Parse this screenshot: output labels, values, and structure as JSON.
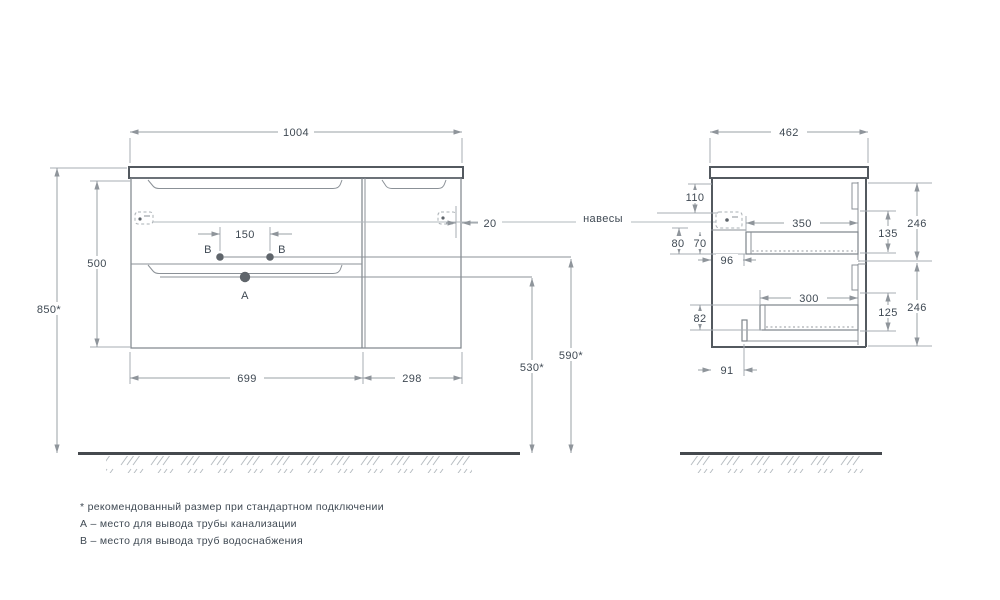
{
  "title": "vanity-cabinet-technical-drawing",
  "colors": {
    "outline": "#53595f",
    "dimension": "#9aa0a6",
    "text": "#3f4953",
    "background": "#ffffff"
  },
  "front": {
    "width": "1004",
    "height": "500",
    "install_height": "850*",
    "drawer_section_width": "699",
    "door_section_width": "298",
    "b_holes_spacing": "150",
    "hanger_edge_gap": "20",
    "drain_line_height": "530*",
    "supply_line_height": "590*",
    "point_a": "A",
    "point_b_left": "B",
    "point_b_right": "B"
  },
  "side": {
    "depth": "462",
    "counter_to_hanger": "110",
    "hanger_offset_a": "80",
    "hanger_offset_b": "70",
    "hanger_inset": "96",
    "top_drawer_depth": "350",
    "top_drawer_clearance": "135",
    "top_drawer_front_height": "246",
    "bottom_drawer_depth": "300",
    "bottom_drawer_clearance": "125",
    "bottom_drawer_front_height": "246",
    "bottom_recess_height": "82",
    "bottom_recess_depth": "91"
  },
  "callouts": {
    "hangers": "навесы"
  },
  "footnotes": [
    "* рекомендованный размер при стандартном подключении",
    "А – место для вывода трубы канализации",
    "В – место для вывода труб водоснабжения"
  ]
}
